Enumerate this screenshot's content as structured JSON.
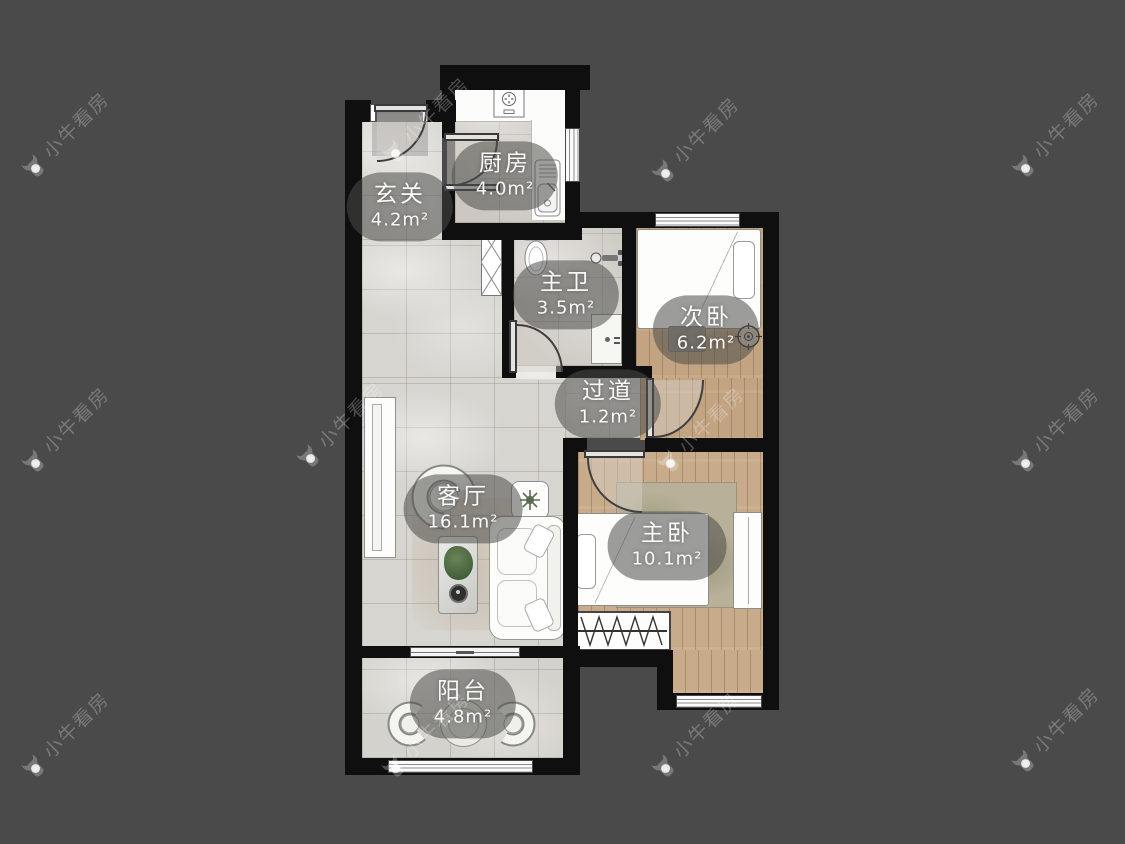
{
  "watermark": {
    "text": "小牛看房"
  },
  "rooms": [
    {
      "id": "kitchen",
      "name": "厨房",
      "area": "4.0m²"
    },
    {
      "id": "entry",
      "name": "玄关",
      "area": "4.2m²"
    },
    {
      "id": "bathroom",
      "name": "主卫",
      "area": "3.5m²"
    },
    {
      "id": "bedroom2",
      "name": "次卧",
      "area": "6.2m²"
    },
    {
      "id": "corridor",
      "name": "过道",
      "area": "1.2m²"
    },
    {
      "id": "living",
      "name": "客厅",
      "area": "16.1m²"
    },
    {
      "id": "master",
      "name": "主卧",
      "area": "10.1m²"
    },
    {
      "id": "balcony",
      "name": "阳台",
      "area": "4.8m²"
    }
  ],
  "colors": {
    "background": "#4a4a4a",
    "wall": "#0f0f0f",
    "tile_floor": "#d7d5d0",
    "wood_floor": "#c2a482",
    "label_bubble": "rgba(76,76,73,0.55)",
    "label_text": "#f8f8f7"
  }
}
